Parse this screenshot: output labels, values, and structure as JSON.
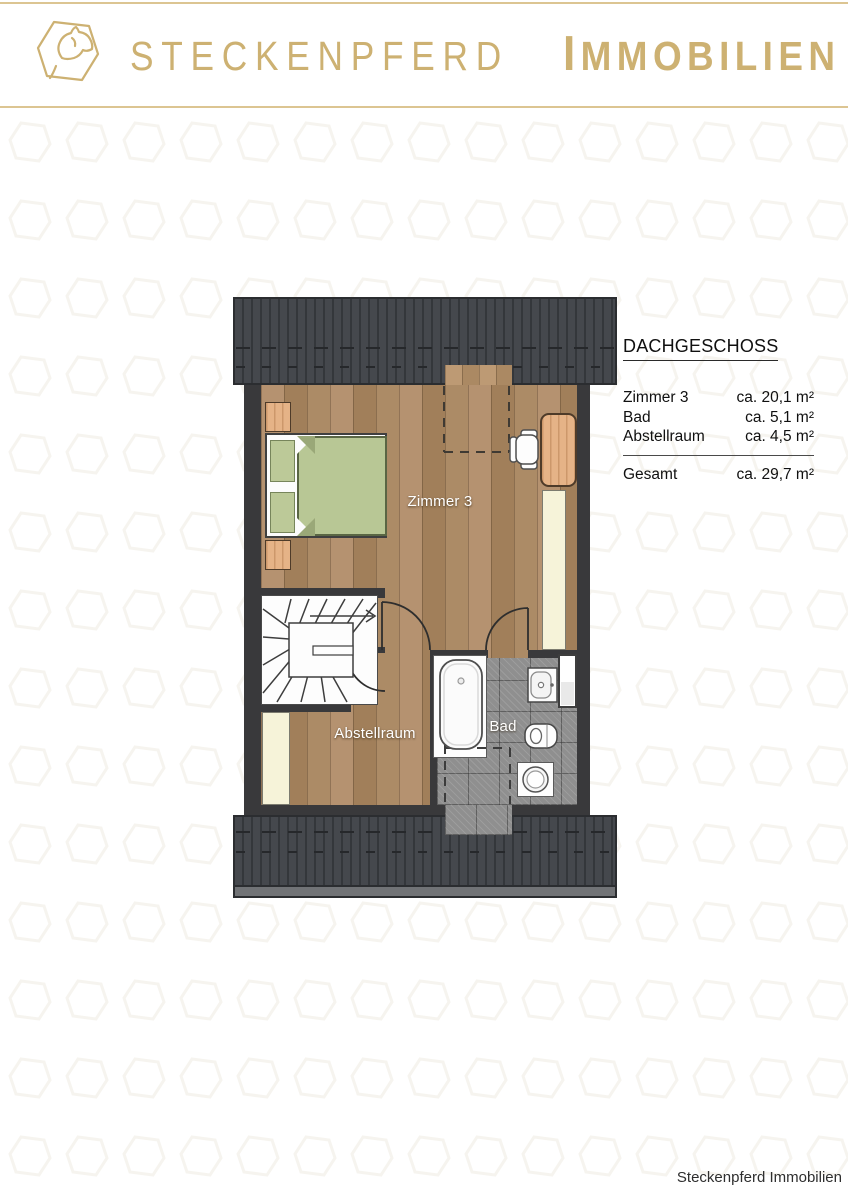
{
  "header": {
    "brand_primary": "STECKENPFERD",
    "brand_secondary": "IMMOBILIEN"
  },
  "legend": {
    "title": "DACHGESCHOSS",
    "rows": [
      {
        "label": "Zimmer 3",
        "value": "ca. 20,1 m²"
      },
      {
        "label": "Bad",
        "value": "ca. 5,1 m²"
      },
      {
        "label": "Abstellraum",
        "value": "ca. 4,5 m²"
      }
    ],
    "total_label": "Gesamt",
    "total_value": "ca. 29,7 m²"
  },
  "floorplan": {
    "labels": {
      "zimmer3": "Zimmer 3",
      "abstellraum": "Abstellraum",
      "bad": "Bad"
    }
  },
  "footer": {
    "credit": "Steckenpferd Immobilien"
  },
  "colors": {
    "gold": "#cdb172",
    "gold_line": "#dcc592",
    "roof": "#3f4246",
    "wall": "#39393b",
    "wood": "#a8865f",
    "tile": "#8f8f8f",
    "cream": "#f6f3d9",
    "duvet_green": "#b8c795"
  }
}
